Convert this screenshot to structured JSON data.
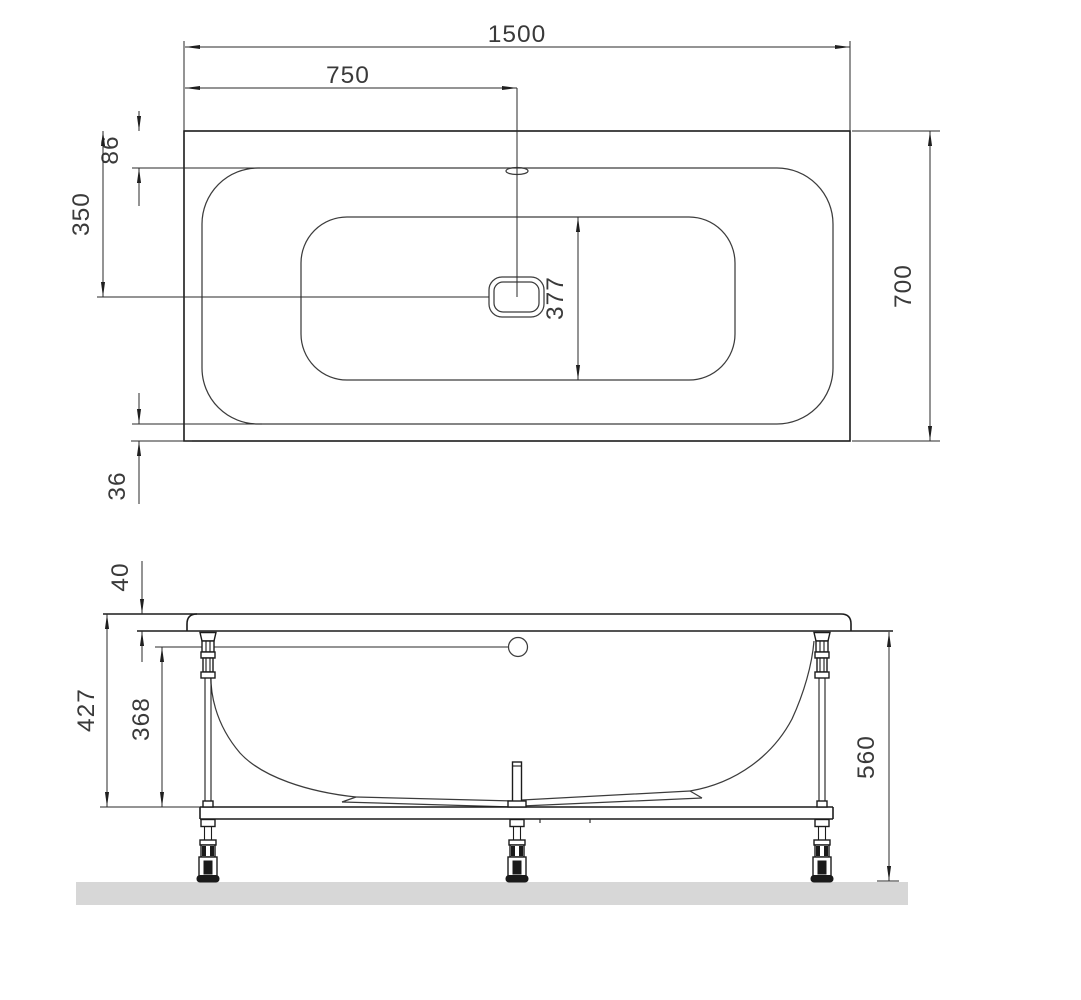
{
  "top_view": {
    "overall_length": "1500",
    "drain_center_from_left": "750",
    "rim_inset_top": "86",
    "drain_center_from_top_edge": "350",
    "basin_inner_width": "377",
    "overall_width": "700",
    "rim_inset_bottom": "36"
  },
  "side_view": {
    "rim_thickness": "40",
    "rim_top_to_frame": "427",
    "overflow_to_frame": "368",
    "rim_bottom_to_floor": "560"
  },
  "colors": {
    "line": "#1c1c1c",
    "dimension": "#2a2a2a",
    "text": "#3a3a3a",
    "floor": "#d7d7d7",
    "background": "#ffffff"
  }
}
